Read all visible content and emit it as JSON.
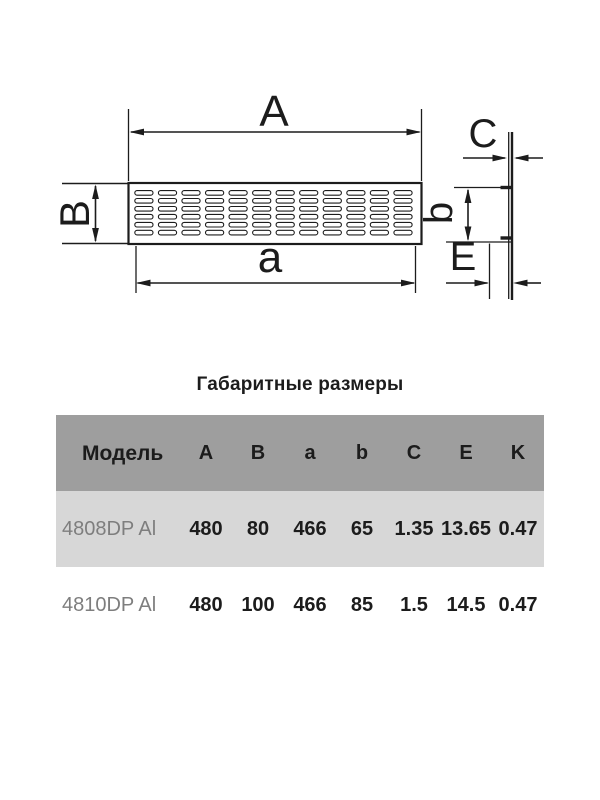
{
  "drawing": {
    "front_view": {
      "label_outer_width": "A",
      "label_outer_height": "B",
      "label_inner_width": "a"
    },
    "side_view": {
      "label_thickness": "C",
      "label_inner_height": "b",
      "label_depth": "E"
    }
  },
  "spec_table": {
    "title": "Габаритные размеры",
    "columns": [
      "Модель",
      "A",
      "B",
      "a",
      "b",
      "C",
      "E",
      "K"
    ],
    "rows": [
      {
        "model": "4808DP Al",
        "A": "480",
        "B": "80",
        "a": "466",
        "b": "65",
        "C": "1.35",
        "E": "13.65",
        "K": "0.47"
      },
      {
        "model": "4810DP Al",
        "A": "480",
        "B": "100",
        "a": "466",
        "b": "85",
        "C": "1.5",
        "E": "14.5",
        "K": "0.47"
      }
    ]
  },
  "colors": {
    "header_bg": "#9e9e9e",
    "row_alt_bg": "#d7d7d7",
    "ink": "#1c1c1c",
    "model_text": "#7e7e7e"
  }
}
